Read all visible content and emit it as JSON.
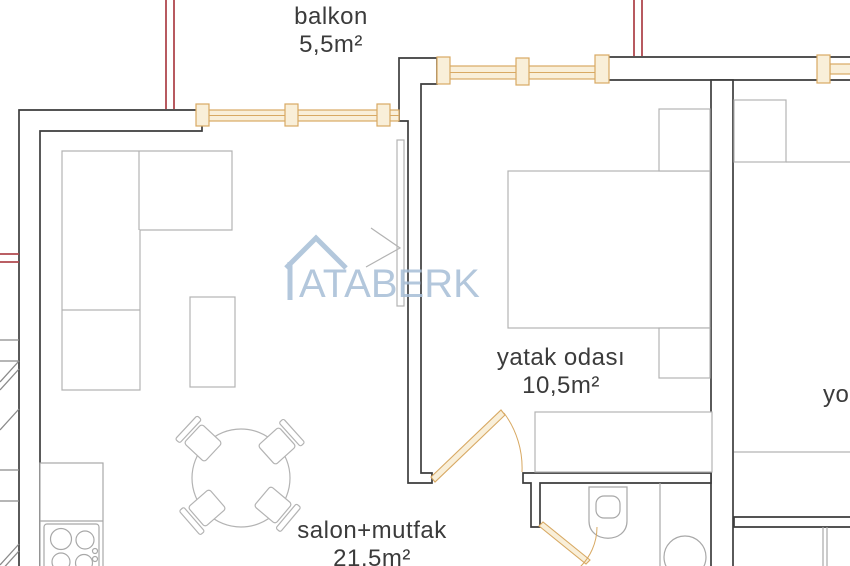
{
  "plan_title": "apartment floor plan",
  "watermark": {
    "text": "ATABERK"
  },
  "rooms": [
    {
      "id": "balkon",
      "name": "balkon",
      "area": "5,5m²"
    },
    {
      "id": "yatak-odasi",
      "name": "yatak odası",
      "area": "10,5m²"
    },
    {
      "id": "salon-mutfak",
      "name": "salon+mutfak",
      "area": "21,5m²"
    },
    {
      "id": "adjacent-room-partial",
      "name": "yo",
      "area": ""
    }
  ],
  "colors": {
    "wall": "#3d3d3d",
    "furniture": "#b3b3b3",
    "fixture": "#a8a8a8",
    "window_stroke": "#d8a963",
    "window_fill": "#f9efd9",
    "red": "#b0484e",
    "stairs": "#8a8a8a",
    "watermark": "#a6bed6",
    "label": "#3b3b3b"
  }
}
